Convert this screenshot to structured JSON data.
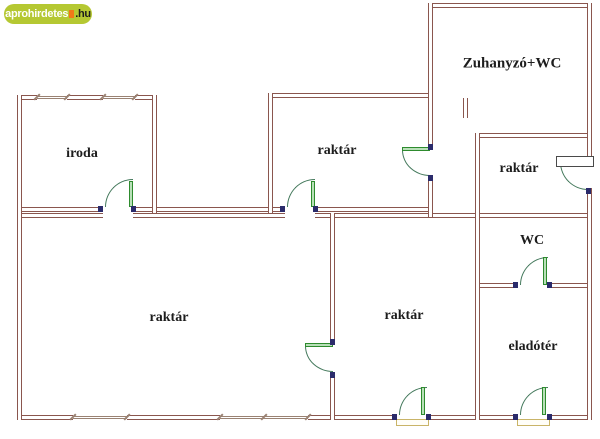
{
  "logo": {
    "brand": "aprohirdetes",
    "tld": ".hu"
  },
  "floorplan": {
    "rooms": [
      {
        "id": "iroda",
        "label": "iroda"
      },
      {
        "id": "raktar-top",
        "label": "raktár"
      },
      {
        "id": "zuhanyzo-wc",
        "label": "Zuhanyzó+WC"
      },
      {
        "id": "raktar-right",
        "label": "raktár"
      },
      {
        "id": "wc",
        "label": "WC"
      },
      {
        "id": "eladoter",
        "label": "eladótér"
      },
      {
        "id": "raktar-big",
        "label": "raktár"
      },
      {
        "id": "raktar-mid",
        "label": "raktár"
      }
    ]
  },
  "colors": {
    "wall": "#8a564e",
    "window": "#9a8273",
    "door_frame": "#2e8b2e",
    "door_fill": "#b9e0b9",
    "door_arc": "#44795c",
    "threshold": "#c9b468",
    "label": "#1d1d1d",
    "logo_bg": "#b5c832",
    "logo_brand": "#ffffff",
    "logo_tld": "#1c1c1c",
    "logo_accent": "#f07818"
  }
}
